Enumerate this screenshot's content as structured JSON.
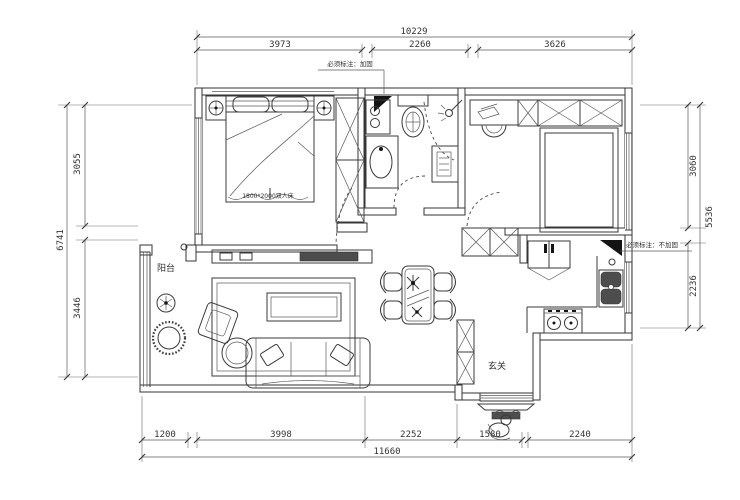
{
  "drawing": {
    "type": "apartment floor plan",
    "colors": {
      "line": "#3a3a3a",
      "wall": "#333333",
      "dark_fill": "#4d4d4d",
      "marker": "#141414",
      "bg": "#ffffff"
    }
  },
  "dims": {
    "top": {
      "all": "10229",
      "s": [
        "3973",
        "2260",
        "3626"
      ]
    },
    "bottom": {
      "all": "11660",
      "s": [
        "1200",
        "3998",
        "2252",
        "1580",
        "2240"
      ]
    },
    "left": {
      "all": "6741",
      "s": [
        "3055",
        "3446"
      ]
    },
    "right": {
      "all": "5536",
      "s": [
        "3060",
        "2236"
      ]
    }
  },
  "labels": {
    "balcony": "阳台",
    "entrance": "玄关",
    "bed": "1800*2000双人床",
    "note_top": "必须标注：加固",
    "note_right": "必须标注：不加固"
  }
}
